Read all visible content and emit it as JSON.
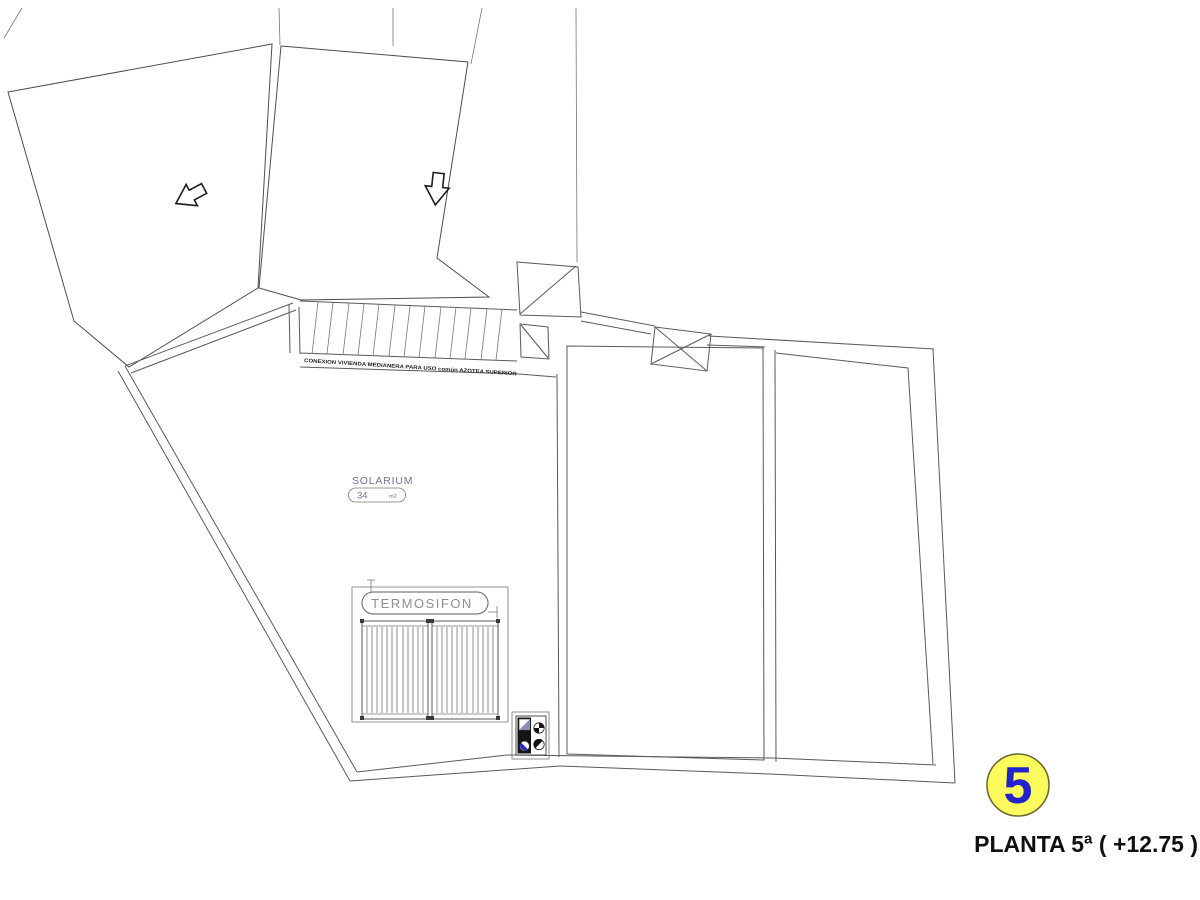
{
  "plan": {
    "stair_note": "CONEXION VIVIENDA MEDIANERA PARA USO común AZOTEA SUPERIOR",
    "solarium": {
      "title": "SOLARIUM",
      "area_value": "34",
      "area_unit": "m2"
    },
    "termosifon_label": "TERMOSIFON",
    "floor_badge": {
      "number": "5"
    },
    "caption": "PLANTA 5ª ( +12.75 )",
    "colors": {
      "badge_fill": "#fbfb5e",
      "badge_stroke": "#6b6b2f",
      "badge_number": "#2323cb",
      "label_blue": "#6e7190",
      "symbol_blue": "#2228c8",
      "line": "#555555"
    }
  }
}
